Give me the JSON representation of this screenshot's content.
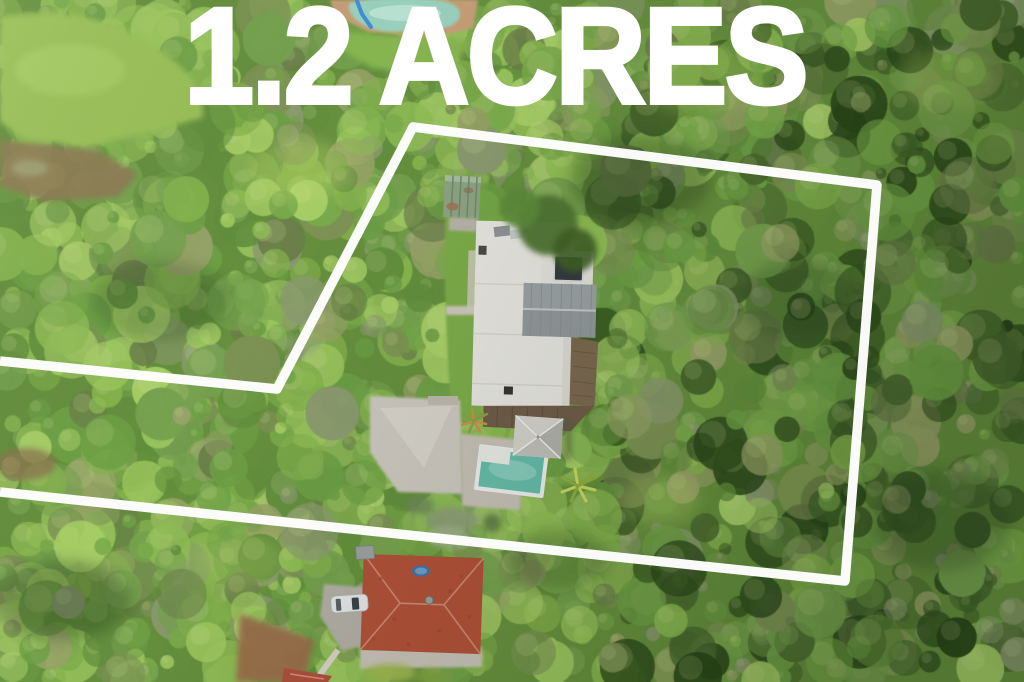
{
  "overlay": {
    "headline": "1.2 ACRES",
    "text_color": "#ffffff",
    "boundary_color": "#ffffff",
    "boundary_points": [
      [
        0,
        361
      ],
      [
        277,
        389
      ],
      [
        413,
        127
      ],
      [
        877,
        185
      ],
      [
        845,
        581
      ],
      [
        0,
        492
      ]
    ]
  },
  "scene": {
    "description": "aerial drone photo of a bush property outlined in white",
    "features": [
      "tree-canopy",
      "front-lawn",
      "neighbor-pool",
      "neighbor-pool-slide",
      "garden-shed",
      "main-house-white-roof",
      "gray-gable-roof",
      "skylight",
      "timber-deck",
      "concrete-patio",
      "backyard-pool",
      "pool-pavilion",
      "palm-trees",
      "neighbor-red-roof-house",
      "parked-car",
      "driveway",
      "footpath",
      "trampoline",
      "property-boundary-outline"
    ],
    "palette": {
      "base": "#66903e",
      "light": [
        "#8fbd55",
        "#9cc75f",
        "#a8cf68",
        "#85b34e"
      ],
      "mid": [
        "#6ea046",
        "#7aab4b",
        "#628f3d",
        "#76a24f"
      ],
      "olive": [
        "#7d9355",
        "#6b7f4a",
        "#8b9b70",
        "#97a368"
      ],
      "dark": [
        "#33521f",
        "#3f6128",
        "#2a4619",
        "#48672e"
      ],
      "sun": "#d8e8a0",
      "pool_water": "#66bcaa",
      "red_roof": "#b05138",
      "white_roof": "#e6e5e0"
    }
  }
}
